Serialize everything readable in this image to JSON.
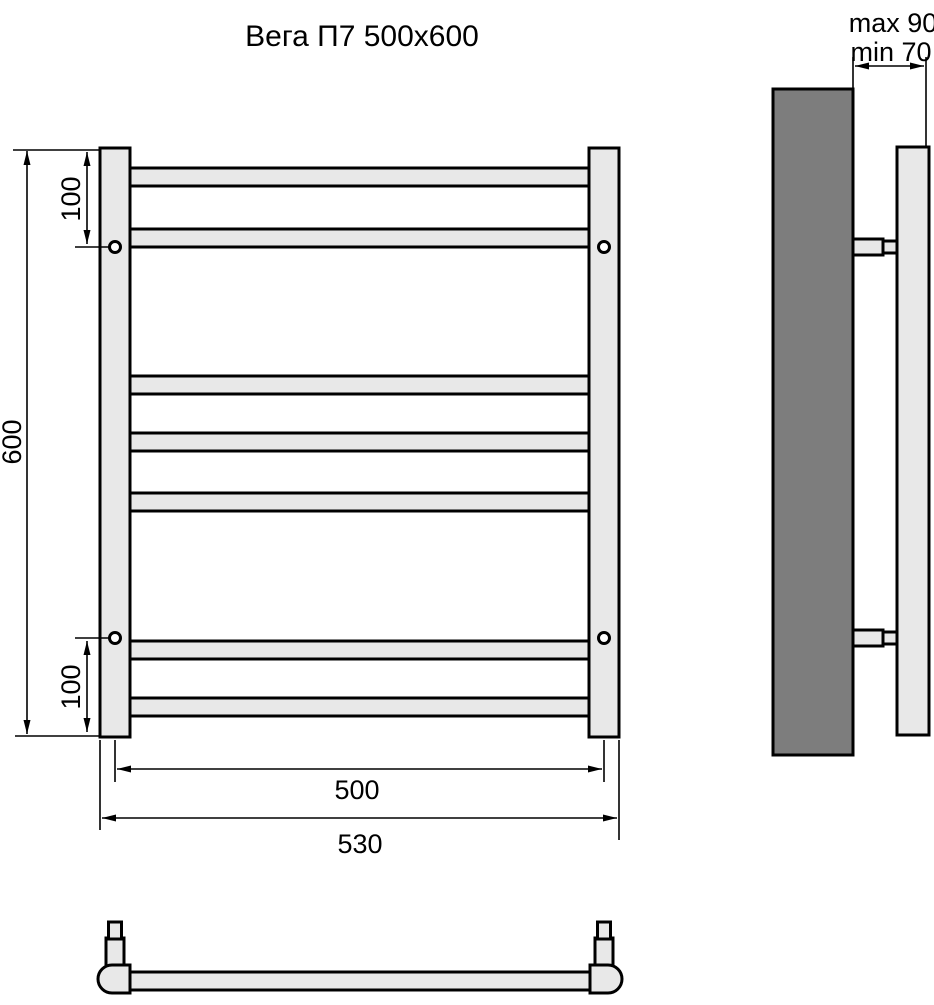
{
  "title": "Вега П7 500x600",
  "colors": {
    "background": "#ffffff",
    "outline": "#000000",
    "fill_light": "#e8e8e8",
    "fill_dark": "#7d7d7d"
  },
  "front_view": {
    "rungs": 7,
    "mounting_holes": 4,
    "dim_height": "600",
    "dim_top_offset": "100",
    "dim_bottom_offset": "100",
    "dim_width_centers": "500",
    "dim_width_overall": "530"
  },
  "side_view": {
    "dim_depth_max": "max 90",
    "dim_depth_min": "min 70"
  }
}
